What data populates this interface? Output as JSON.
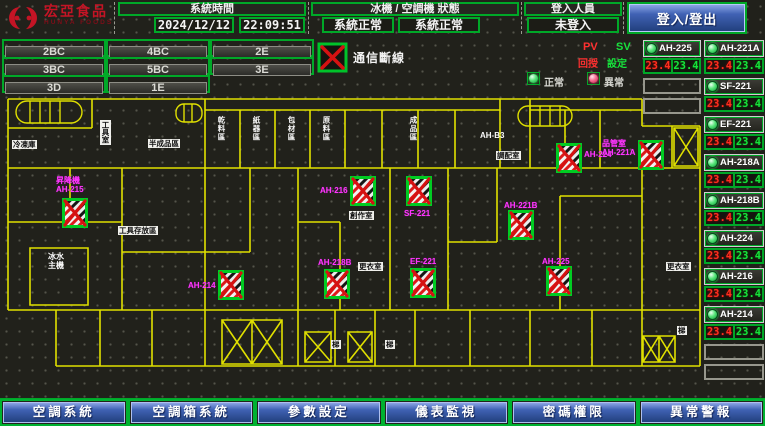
{
  "header": {
    "logo": {
      "brand": "宏亞食品",
      "brand_en": "HUNYA FOODS"
    },
    "system_time": {
      "label": "系統時間",
      "date": "2024/12/12",
      "time": "22:09:51"
    },
    "status": {
      "label": "冰機 / 空調機 狀態",
      "chiller": "系統正常",
      "ac": "系統正常"
    },
    "login": {
      "label": "登入人員",
      "value": "未登入",
      "button": "登入/登出"
    }
  },
  "floor_buttons": [
    "2BC",
    "4BC",
    "2E",
    "3BC",
    "5BC",
    "3E",
    "3D",
    "1E"
  ],
  "legend": {
    "comm_loss": "通信斷線",
    "pv": "PV",
    "sv": "SV",
    "feedback": "回授",
    "setpoint": "設定",
    "normal": "正常",
    "abnormal": "異常",
    "colors": {
      "pv": "#ff3030",
      "sv": "#17e23c",
      "wall": "#e0e000",
      "label": "#ff35ff"
    }
  },
  "right_panel": {
    "col_a": {
      "units": [
        {
          "name": "AH-225",
          "pv": "23.4",
          "sv": "23.4"
        }
      ],
      "empty_rows": 2
    },
    "col_b": {
      "units": [
        {
          "name": "AH-221A",
          "pv": "23.4",
          "sv": "23.4"
        },
        {
          "name": "SF-221",
          "pv": "23.4",
          "sv": "23.4"
        },
        {
          "name": "EF-221",
          "pv": "23.4",
          "sv": "23.4"
        },
        {
          "name": "AH-218A",
          "pv": "23.4",
          "sv": "23.4"
        },
        {
          "name": "AH-218B",
          "pv": "23.4",
          "sv": "23.4"
        },
        {
          "name": "AH-224",
          "pv": "23.4",
          "sv": "23.4"
        },
        {
          "name": "AH-216",
          "pv": "23.4",
          "sv": "23.4"
        },
        {
          "name": "AH-214",
          "pv": "23.4",
          "sv": "23.4"
        }
      ],
      "empty_rows": 2
    }
  },
  "bottom_nav": [
    "空調系統",
    "空調箱系統",
    "參數設定",
    "儀表監視",
    "密碼權限",
    "異常警報"
  ],
  "floor_plan": {
    "units": [
      {
        "name": "AH-215",
        "x": 62,
        "y": 198,
        "label_lines": [
          "昇降機",
          "AH-215"
        ],
        "lx": 56,
        "ly": 176
      },
      {
        "name": "AH-214",
        "x": 218,
        "y": 270,
        "label_lines": [
          "AH-214"
        ],
        "lx": 188,
        "ly": 281
      },
      {
        "name": "AH-216",
        "x": 350,
        "y": 176,
        "label_lines": [
          "AH-216"
        ],
        "lx": 320,
        "ly": 186
      },
      {
        "name": "SF-221",
        "x": 406,
        "y": 176,
        "label_lines": [
          "SF-221"
        ],
        "lx": 404,
        "ly": 209
      },
      {
        "name": "AH-218B",
        "x": 324,
        "y": 269,
        "label_lines": [
          "AH-218B"
        ],
        "lx": 318,
        "ly": 258
      },
      {
        "name": "EF-221",
        "x": 410,
        "y": 268,
        "label_lines": [
          "EF-221"
        ],
        "lx": 410,
        "ly": 257
      },
      {
        "name": "AH-224",
        "x": 556,
        "y": 143,
        "label_lines": [
          "AH-224"
        ],
        "lx": 584,
        "ly": 150
      },
      {
        "name": "AH-221A",
        "x": 638,
        "y": 140,
        "label_lines": [
          "品管室",
          "AH-221A"
        ],
        "lx": 602,
        "ly": 139
      },
      {
        "name": "AH-221B",
        "x": 508,
        "y": 210,
        "label_lines": [
          "AH-221B"
        ],
        "lx": 504,
        "ly": 201
      },
      {
        "name": "AH-225",
        "x": 546,
        "y": 266,
        "label_lines": [
          "AH-225"
        ],
        "lx": 542,
        "ly": 257
      }
    ],
    "rooms": [
      {
        "text": "冷凍庫",
        "x": 12,
        "y": 140,
        "variant": "box"
      },
      {
        "text": "工具室",
        "x": 100,
        "y": 120,
        "variant": "vbox"
      },
      {
        "text": "半成品區",
        "x": 148,
        "y": 139,
        "variant": "box"
      },
      {
        "text": "乾料區",
        "x": 216,
        "y": 116,
        "variant": "vplain"
      },
      {
        "text": "紙器區",
        "x": 251,
        "y": 116,
        "variant": "vplain"
      },
      {
        "text": "包材區",
        "x": 286,
        "y": 116,
        "variant": "vplain"
      },
      {
        "text": "原料區",
        "x": 321,
        "y": 116,
        "variant": "vplain"
      },
      {
        "text": "成品區",
        "x": 408,
        "y": 116,
        "variant": "vplain"
      },
      {
        "text": "工具存放區",
        "x": 118,
        "y": 226,
        "variant": "box"
      },
      {
        "text": "冰水\n主機",
        "x": 48,
        "y": 252,
        "variant": "plain"
      },
      {
        "text": "創作室",
        "x": 349,
        "y": 211,
        "variant": "box"
      },
      {
        "text": "更衣室",
        "x": 358,
        "y": 262,
        "variant": "box"
      },
      {
        "text": "調配室",
        "x": 496,
        "y": 151,
        "variant": "box"
      },
      {
        "text": "AH-B3",
        "x": 480,
        "y": 131,
        "variant": "plain"
      },
      {
        "text": "更衣室",
        "x": 666,
        "y": 262,
        "variant": "box"
      },
      {
        "text": "梯",
        "x": 331,
        "y": 340,
        "variant": "box"
      },
      {
        "text": "梯",
        "x": 385,
        "y": 340,
        "variant": "box"
      },
      {
        "text": "梯",
        "x": 677,
        "y": 326,
        "variant": "box"
      }
    ]
  }
}
